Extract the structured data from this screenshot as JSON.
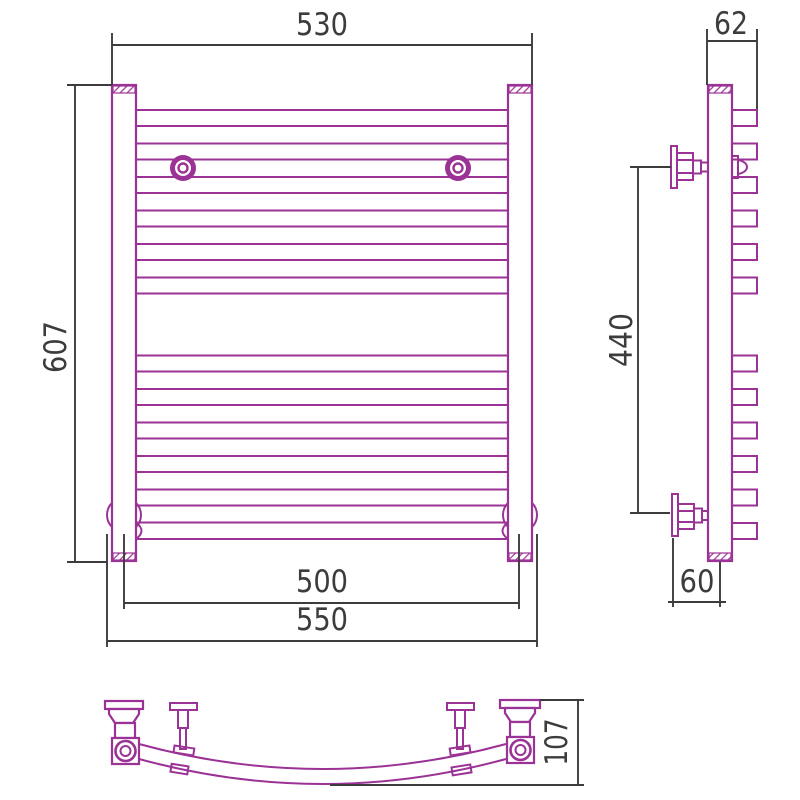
{
  "title": "Heated towel rail technical drawing",
  "colors": {
    "accent": "#9b3295",
    "dim_lines": "#3c3c3c",
    "background": "#ffffff"
  },
  "views": {
    "front": {
      "name": "front-view",
      "dims": {
        "top_width": "530",
        "height": "607",
        "inner_width": "500",
        "overall_width": "550"
      }
    },
    "side": {
      "name": "side-view",
      "dims": {
        "depth": "62",
        "bracket_span": "440",
        "wall_offset": "60"
      }
    },
    "bottom": {
      "name": "bottom-view",
      "dims": {
        "depth": "107"
      }
    }
  }
}
